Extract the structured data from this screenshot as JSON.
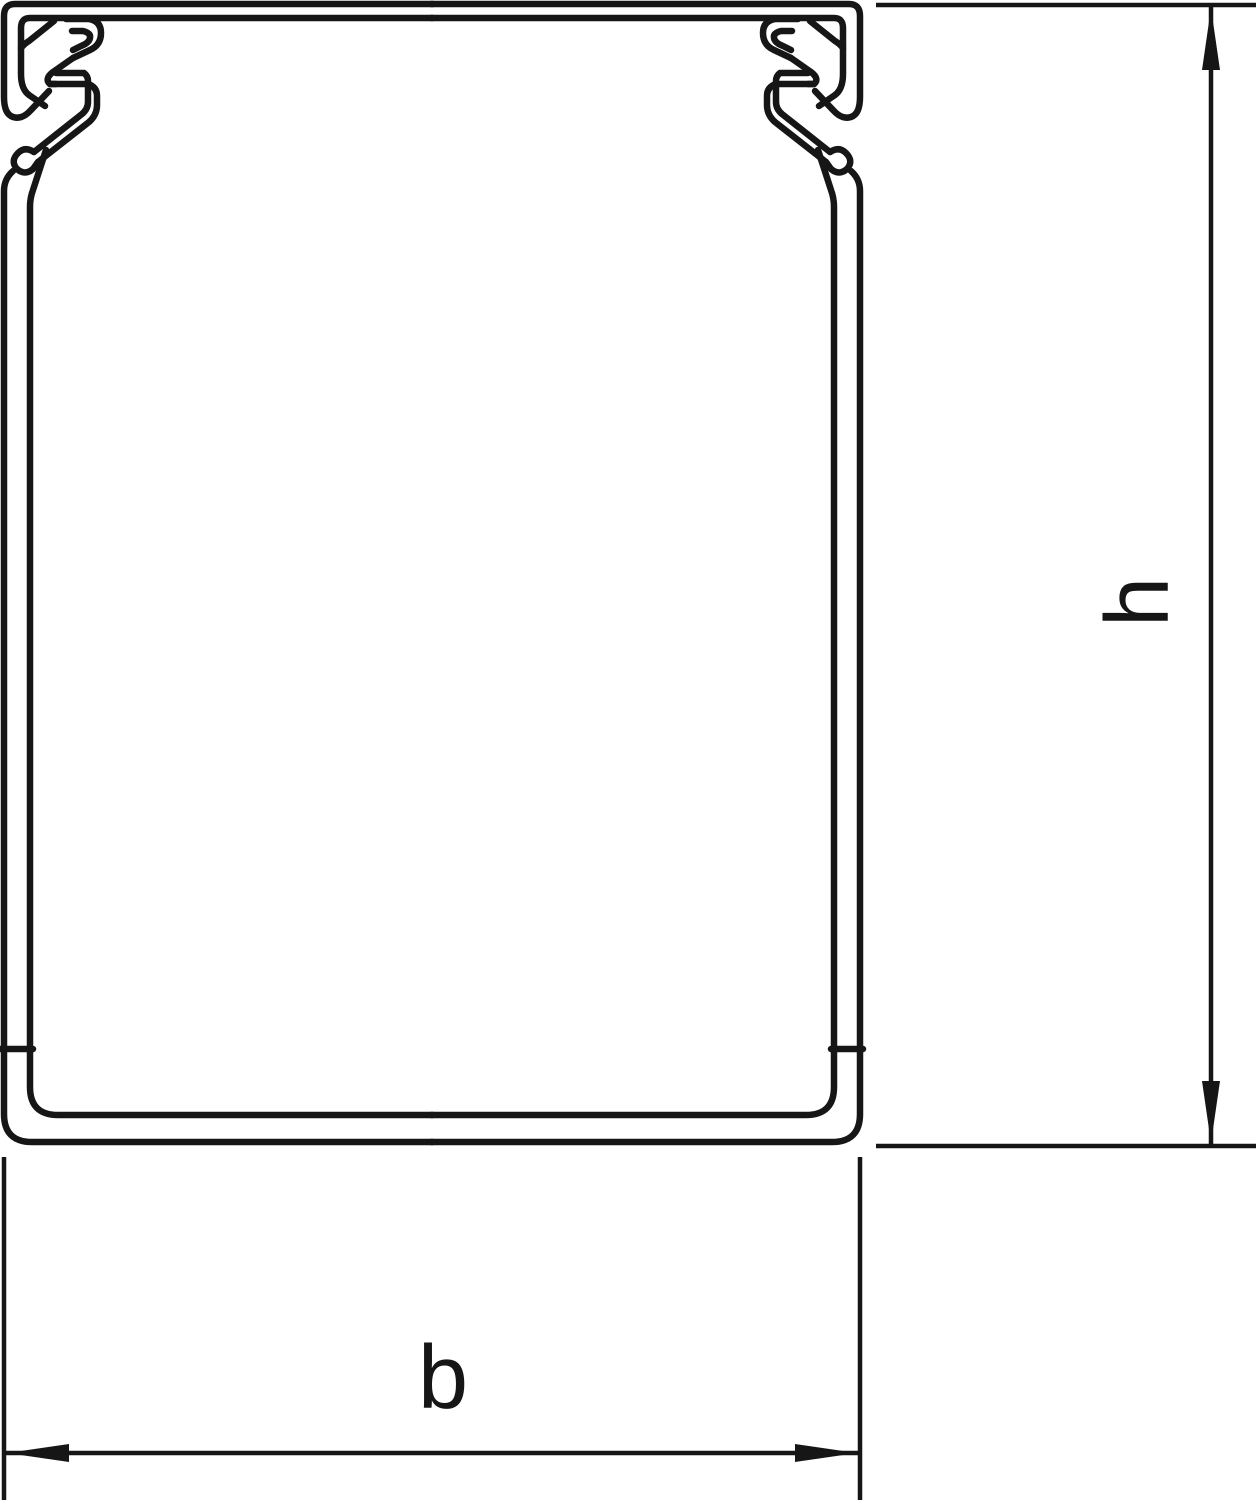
{
  "drawing": {
    "background_color": "#ffffff",
    "line_color": "#161616",
    "subject": "cable-trunking-cross-section",
    "dimension_labels": {
      "height": "h",
      "width": "b"
    }
  }
}
